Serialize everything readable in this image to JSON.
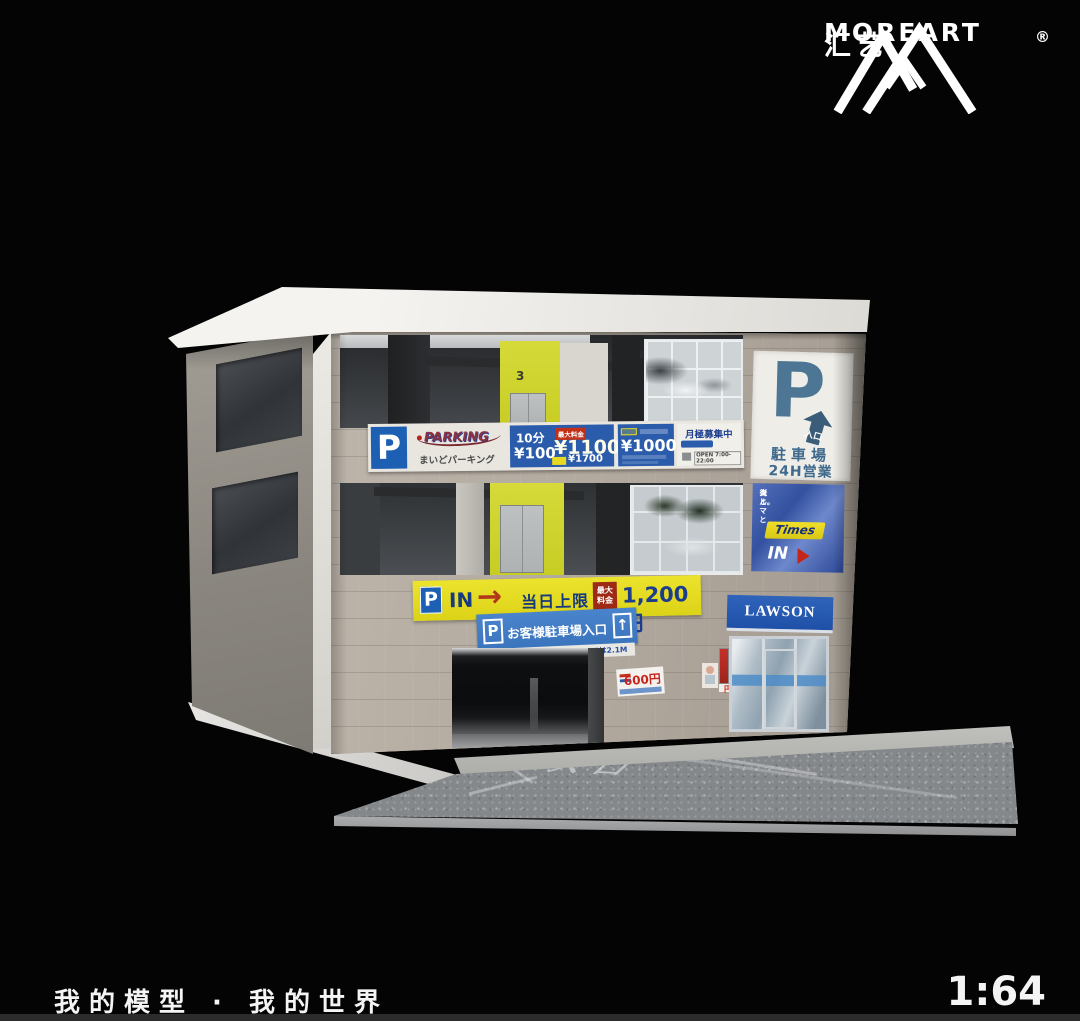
{
  "brand": {
    "name": "MOREART",
    "cjk_name": "汇艺",
    "registered_mark": "®"
  },
  "footer": {
    "slogan": "我的模型 · 我的世界",
    "scale": "1:64"
  },
  "colors": {
    "background": "#040404",
    "parking_blue": "#2b5cac",
    "banner_yellow": "#e3d81e",
    "lawson_blue": "#2355ae",
    "times_blue": "#3a56a8",
    "facade_beige": "#b2aa9f",
    "elevator_wall_yellow": "#cdd22f"
  },
  "diorama": {
    "floor_number": "3",
    "road_marking": "入口",
    "sign_band": {
      "p": "P",
      "parking_title": "PARKING",
      "parking_subtitle": "まいどパーキング",
      "rate1_duration": "10分",
      "rate1_price": "¥100",
      "rate1_max_tag": "最大料金",
      "rate1_max_price": "¥1100",
      "rate1_alt_price": "¥1700",
      "rate2_price": "¥1000",
      "monthly_label": "月極募集中",
      "open_hours": "OPEN 7:00-22:00"
    },
    "core_sign": {
      "p": "P",
      "entrance": "入口",
      "parking_lot": "駐車場",
      "open_24h": "24H営業"
    },
    "times_sign": {
      "tagline1": "人と",
      "tagline2": "クルマと",
      "tagline3": "街と。",
      "brand": "Times",
      "in": "IN"
    },
    "yellow_banner": {
      "p": "P",
      "in": "IN",
      "arrow": "→",
      "daily_limit": "当日上限",
      "max_tag1": "最大",
      "max_tag2": "料金",
      "price": "1,200円"
    },
    "customer_sign": {
      "p": "P",
      "label": "お客様駐車場入口",
      "arrow": "↑",
      "height_limit": "高さ制限 4F,RFは2.3M 5F,6Fは2.1M"
    },
    "posters": {
      "price_600": "600円",
      "price_500": "500円"
    },
    "lawson": {
      "name": "LAWSON"
    }
  }
}
